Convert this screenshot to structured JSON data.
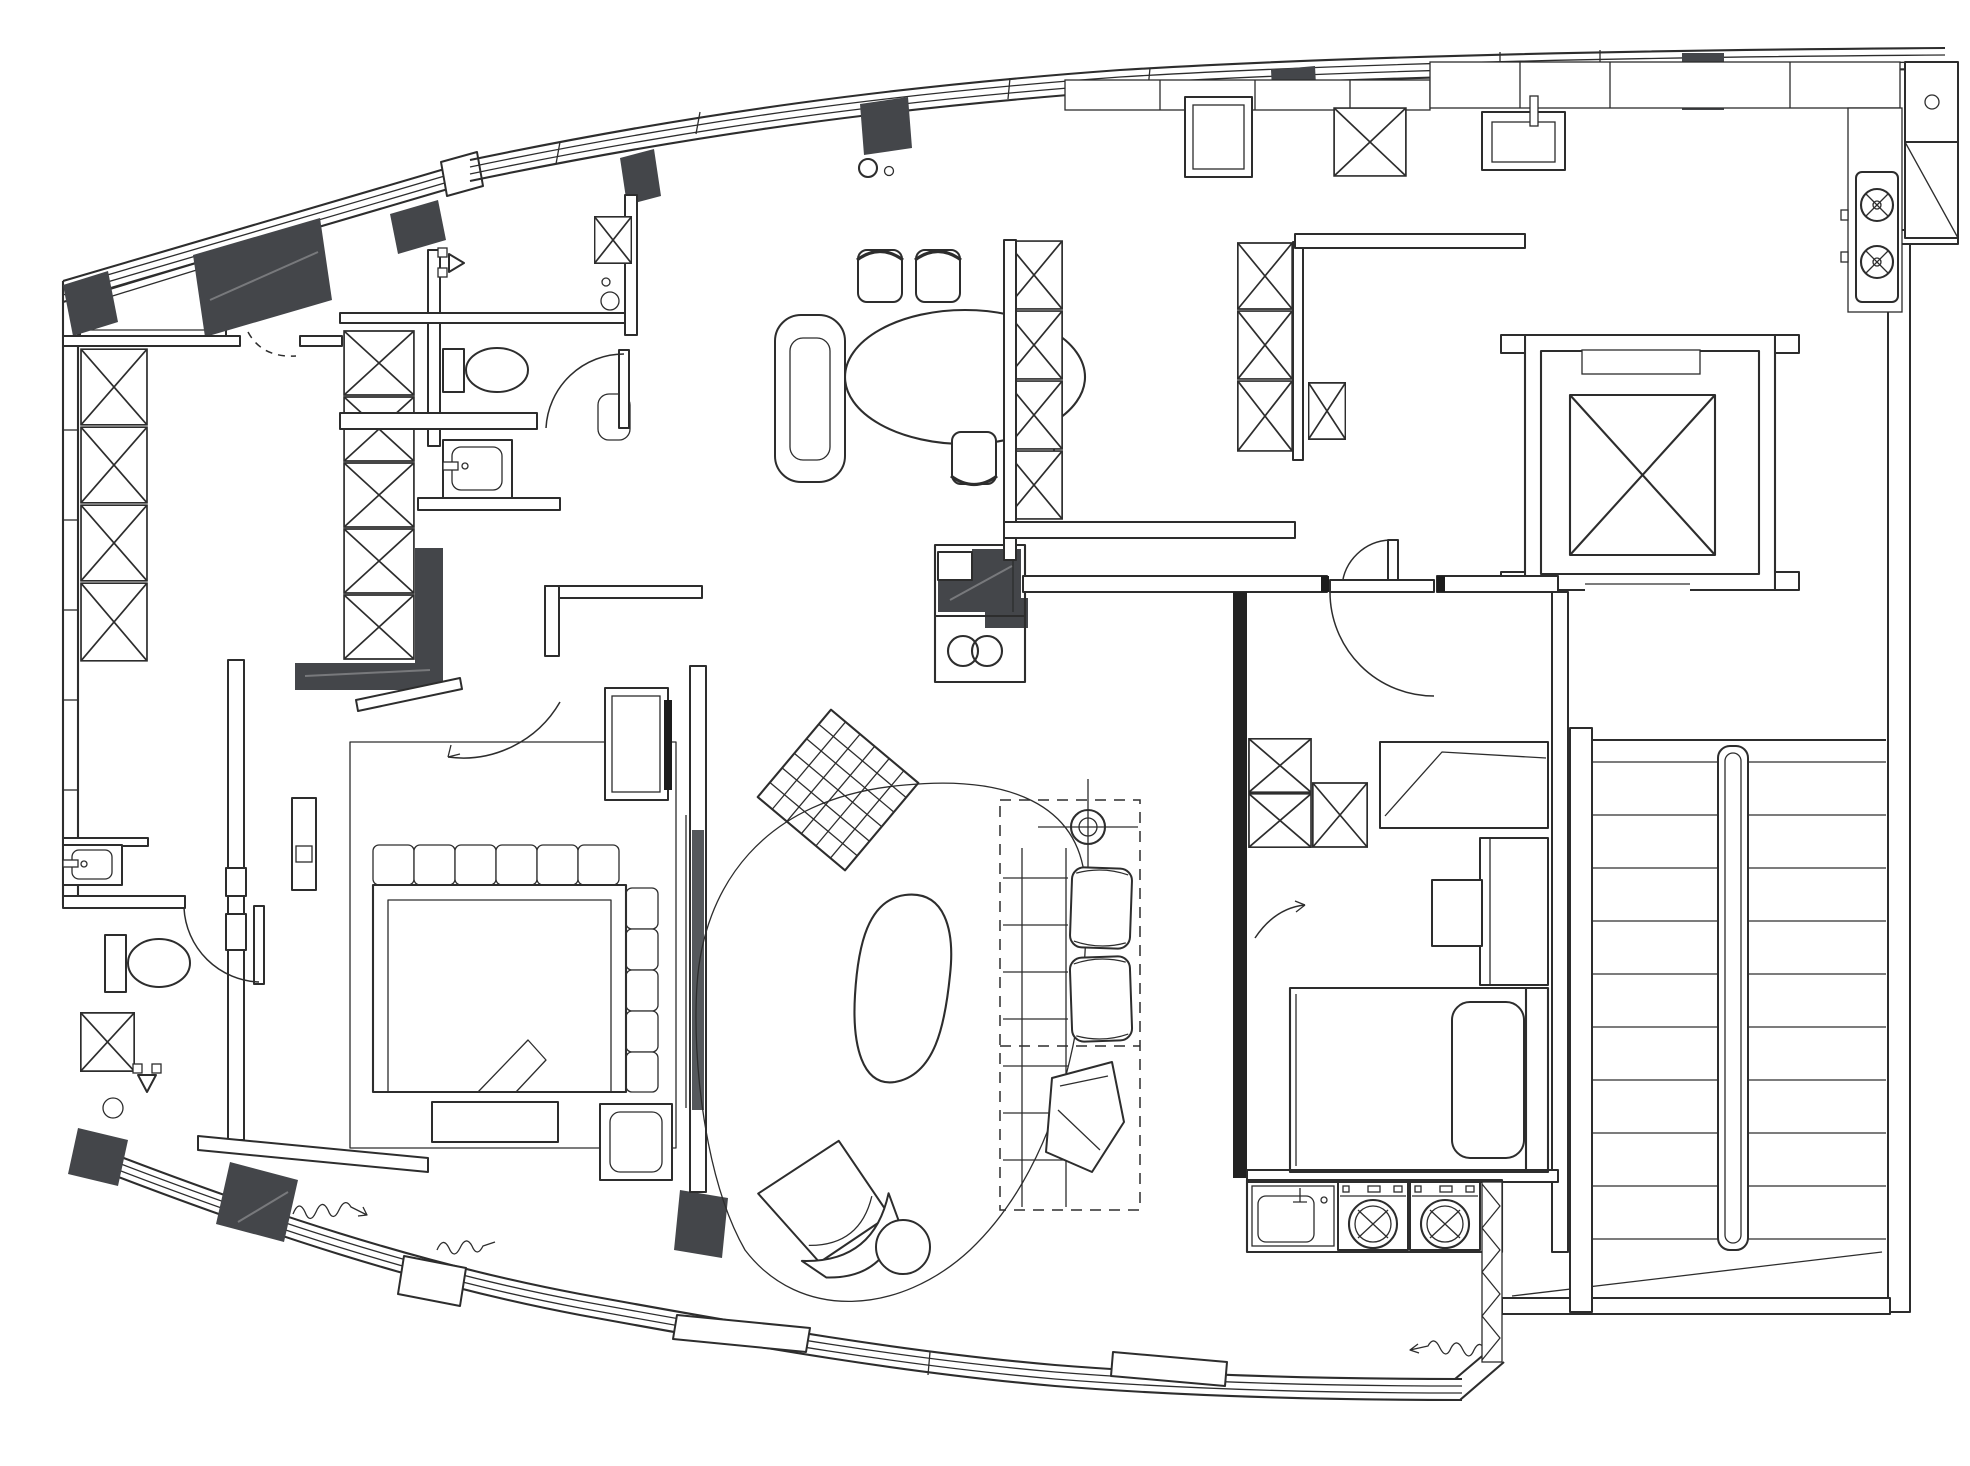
{
  "title": "Apartment floor plan - monochrome architectural CAD drawing",
  "colors": {
    "bg": "#ffffff",
    "line": "#2d2d2d",
    "wall": "#44464a",
    "soft": "#8a8a8a",
    "glass": "#55585c"
  },
  "plan": {
    "drawing_type": "residential-floor-plan",
    "orientation": "curved window walls at top and bottom, service core (elevator + stairs) at right",
    "areas": [
      "entry-foyer",
      "walk-in-closet",
      "shower-bathroom",
      "powder-room",
      "master-bedroom",
      "living-room",
      "dining-area",
      "kitchen",
      "pantry",
      "corridor",
      "second-bedroom",
      "laundry-niche",
      "elevator-shaft",
      "stairwell",
      "window-bays"
    ],
    "fixtures": {
      "dining_table": 1,
      "dining_chairs": 4,
      "dining_bench": 1,
      "media_island": 1,
      "woven_pouf": 1,
      "area_rug": 1,
      "coffee_table": 1,
      "lounge_chair": 1,
      "side_table": 1,
      "sofa_seat_cushions": 2,
      "throw_blanket": 1,
      "ceiling_fan": 1,
      "beds": 2,
      "nightstands": 2,
      "desk": 1,
      "toilets": 2,
      "washbasins": 3,
      "kitchen_sink": 1,
      "laundry_sink": 1,
      "shower_heads": 2,
      "floor_drains": 3,
      "cooktop_burners": 2,
      "washing_machines": 2,
      "elevator_cars": 1,
      "stair_steps": 10,
      "door_swings": 6,
      "wardrobe_units_hatched": 22,
      "structural_columns_dark": 12
    }
  }
}
